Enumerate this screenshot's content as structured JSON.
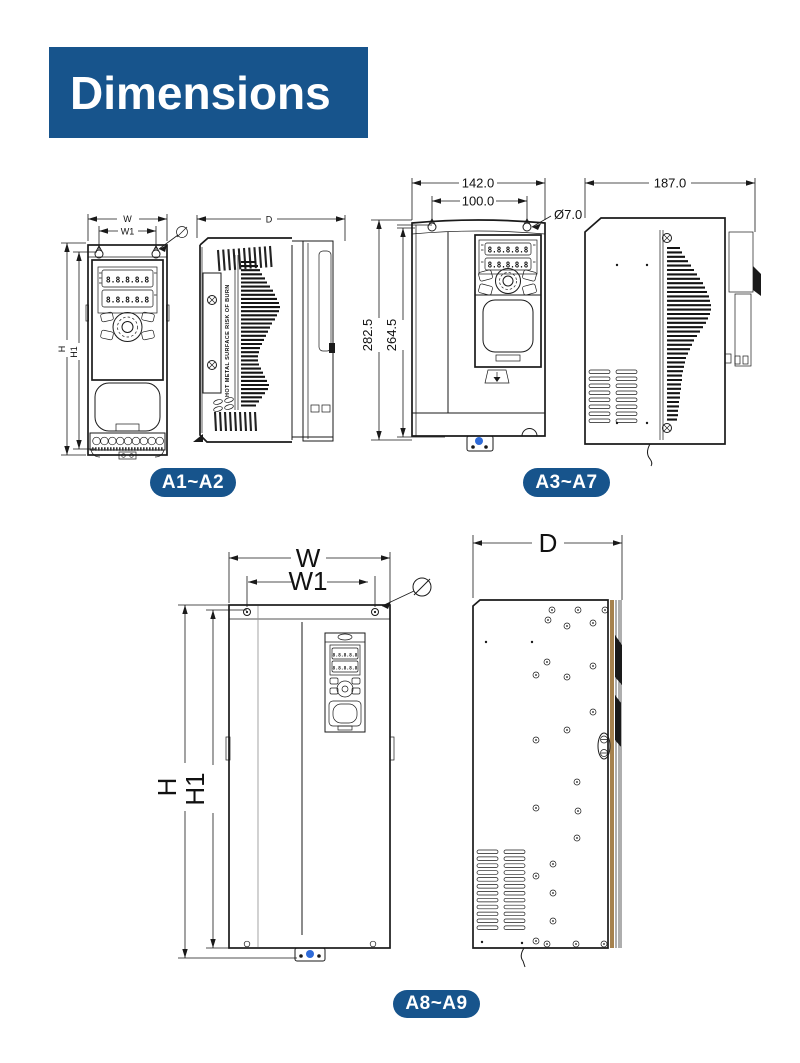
{
  "page": {
    "title": "Dimensions"
  },
  "colors": {
    "brand_blue": "#17548c",
    "badge_blue": "#17548c",
    "line": "#1a1a1a",
    "accent_dot": "#2f6bd8",
    "gasket_tan": "#a6824e"
  },
  "figures": {
    "a1a2": {
      "badge_label": "A1~A2",
      "front": {
        "width_label": "W",
        "width1_label": "W1",
        "height_label": "H",
        "height1_label": "H1",
        "display_digits": "8.8.8.8.8"
      },
      "side": {
        "depth_label": "D",
        "warning_text": "HOT METAL SURFACE RISK OF BURN"
      }
    },
    "a3a7": {
      "badge_label": "A3~A7",
      "front": {
        "width_outer": "142.0",
        "width_inner": "100.0",
        "hole_diameter": "Ø7.0",
        "height_outer": "282.5",
        "height_inner": "264.5",
        "display_digits": "8.8.8.8.8"
      },
      "side": {
        "depth": "187.0"
      }
    },
    "a8a9": {
      "badge_label": "A8~A9",
      "front": {
        "width_label": "W",
        "width1_label": "W1",
        "height_label": "H",
        "height1_label": "H1",
        "display_digits": "8.8.8.8.8"
      },
      "side": {
        "depth_label": "D"
      }
    }
  }
}
